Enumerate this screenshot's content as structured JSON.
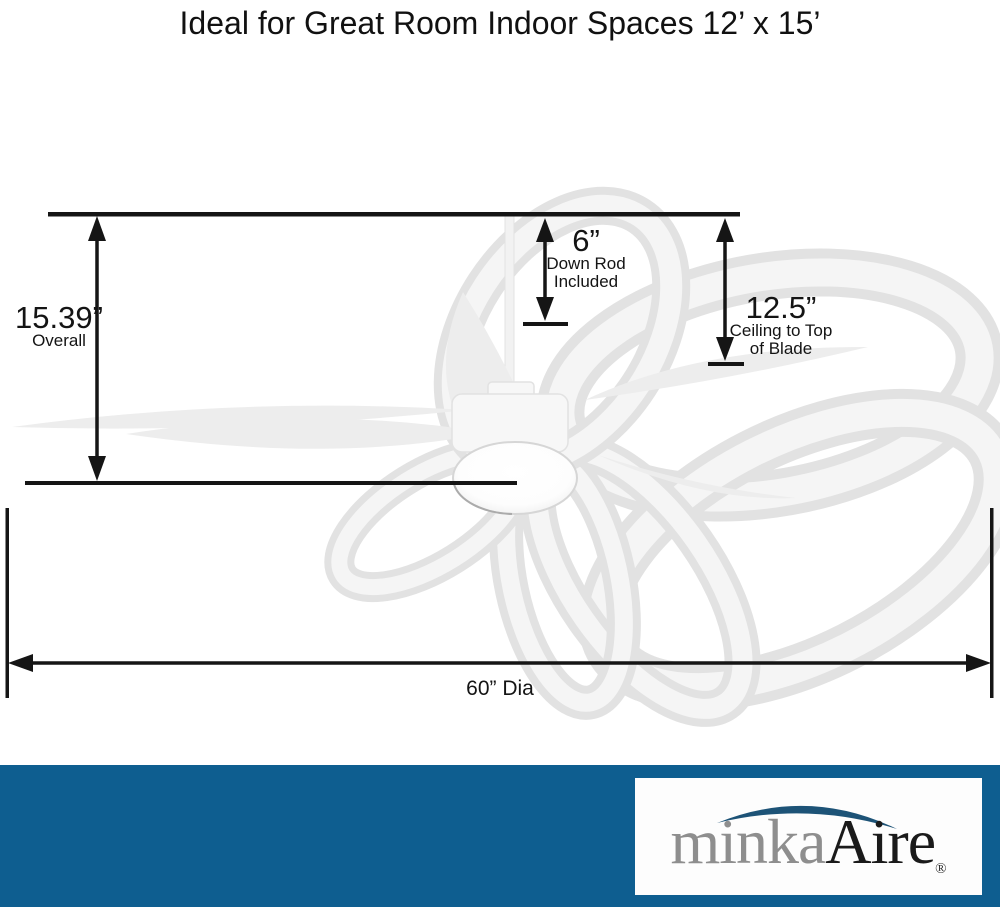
{
  "title": "Ideal for Great Room Indoor Spaces 12’ x 15’",
  "dimensions": {
    "overall": {
      "value": "15.39”",
      "label": "Overall"
    },
    "down_rod": {
      "value": "6”",
      "line1": "Down Rod",
      "line2": "Included"
    },
    "ceiling_to_blade": {
      "value": "12.5”",
      "line1": "Ceiling to Top",
      "line2": "of Blade"
    },
    "diameter": {
      "value": "60” Dia"
    }
  },
  "brand": {
    "word1": "minka",
    "word2": "Aire",
    "registered": "®"
  },
  "colors": {
    "footer_background": "#0E5E90",
    "logo_swoosh": "#1D5377",
    "logo_word1_gray": "#8E8E8E",
    "logo_word2_black": "#1A1A1A",
    "dimension_line": "#151515",
    "fan_edge": "#E2E2E2",
    "fan_highlight": "#F5F5F5",
    "fan_fill": "#EDEDED"
  }
}
